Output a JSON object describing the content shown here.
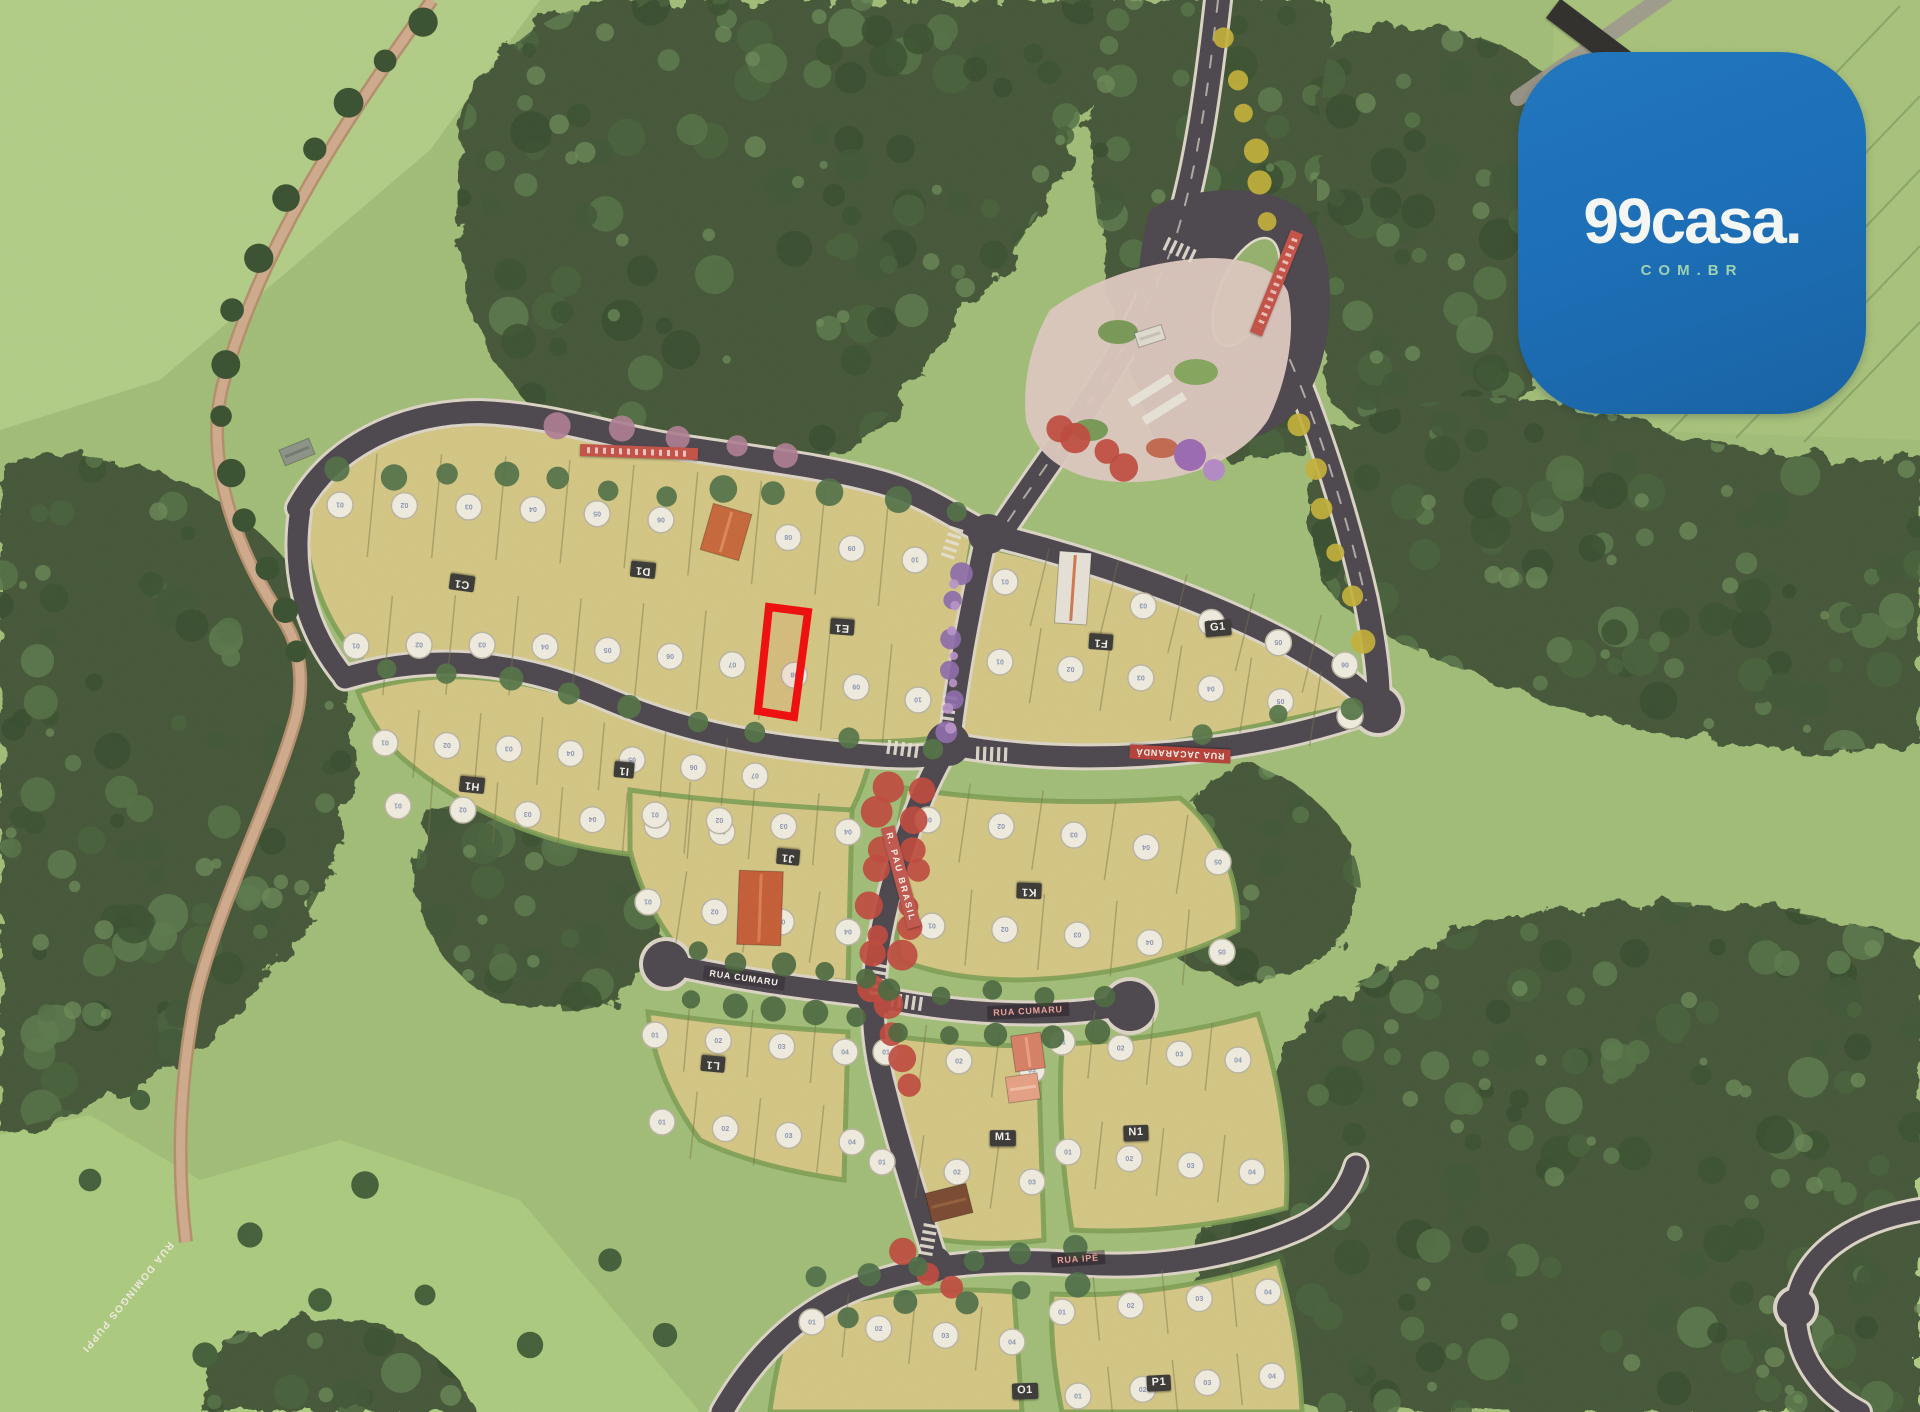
{
  "logo": {
    "title": "99casa.",
    "subtitle": "COM.BR",
    "bg_color": "#1d6fb7",
    "title_color": "#f4f6f3",
    "subtitle_color": "#9ed2b0"
  },
  "map": {
    "type": "masterplan-model-aerial",
    "highlight_color": "#ee1111",
    "street_labels": [
      {
        "name": "RUA JACARANDÁ"
      },
      {
        "name": "R. PAU BRASIL"
      },
      {
        "name": "RUA CUMARU"
      },
      {
        "name": "RUA CUMARU"
      },
      {
        "name": "RUA IPÊ"
      },
      {
        "name": "RUA DOMINGOS PUPPI"
      }
    ],
    "block_labels": [
      "C1",
      "D1",
      "E1",
      "F1",
      "G1",
      "H1",
      "I1",
      "J1",
      "K1",
      "L1",
      "M1",
      "N1",
      "O1",
      "P1"
    ]
  }
}
